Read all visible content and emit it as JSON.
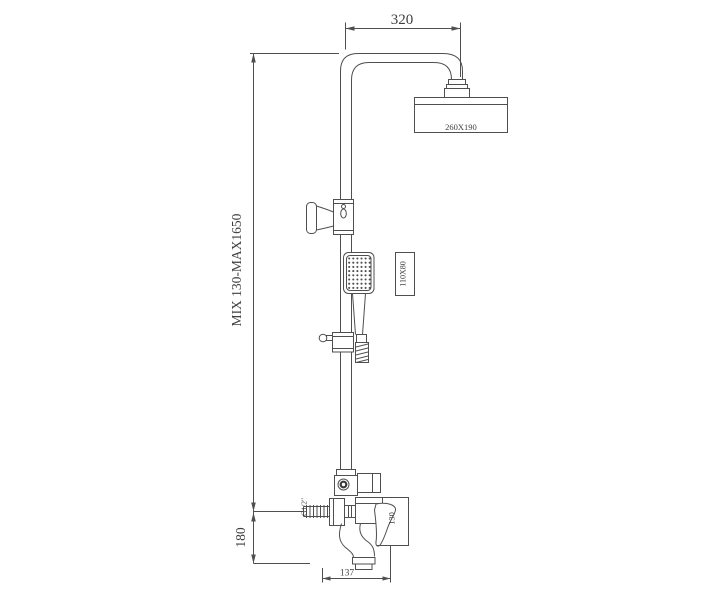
{
  "colors": {
    "background": "#ffffff",
    "line": "#4f4f4f",
    "text": "#3f3f3f"
  },
  "diagram": {
    "kind": "shower-column-technical-drawing",
    "labels": {
      "top_width": "320",
      "height_range": "MIX 130-MAX1650",
      "inlet_drop": "180",
      "spout_reach": "137",
      "rain_head_size": "260X190",
      "hand_shower_size": "110X80",
      "thread": "G1/2\"",
      "body_height": "130"
    }
  }
}
